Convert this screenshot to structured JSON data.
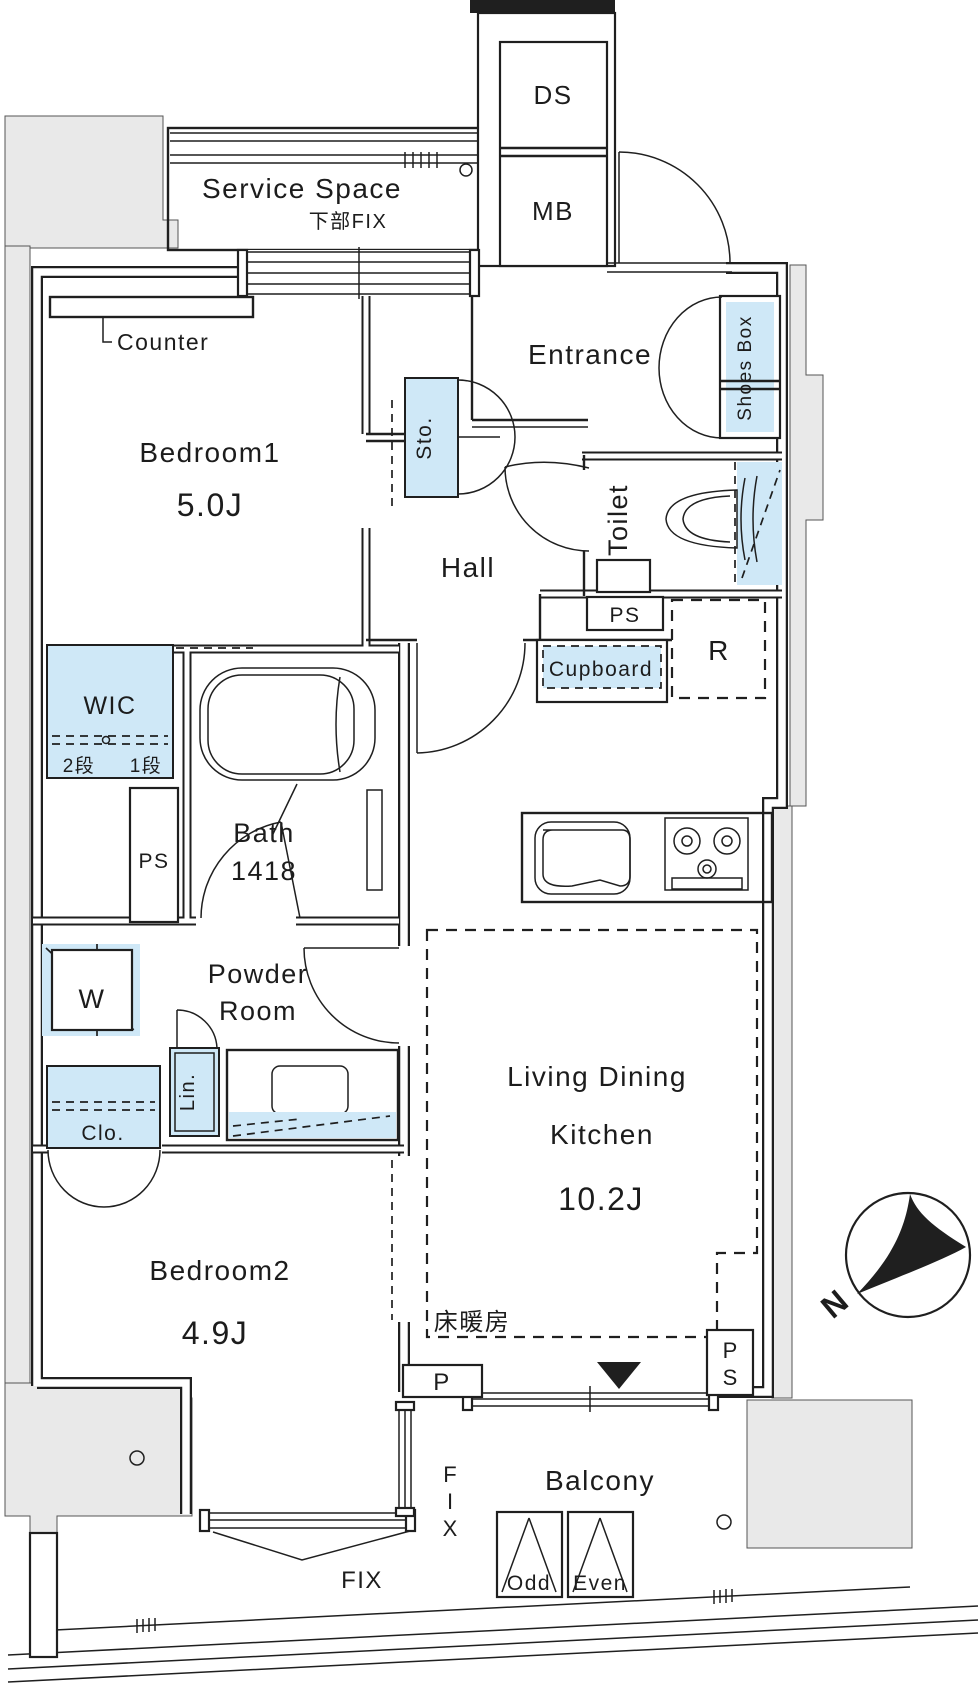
{
  "plan": {
    "type": "apartment-floor-plan",
    "colors": {
      "fixture_blue": "#cfe8f7",
      "outside_grey": "#e9e9e9",
      "wall": "#1f1f1f",
      "background": "#ffffff"
    },
    "labels": {
      "service_space": "Service Space",
      "service_space_sub": "下部FIX",
      "ds": "DS",
      "mb": "MB",
      "entrance": "Entrance",
      "shoes_box": "Shoes Box",
      "toilet": "Toilet",
      "hall": "Hall",
      "storage": "Sto.",
      "counter": "Counter",
      "bedroom1": "Bedroom1",
      "bedroom1_size": "5.0J",
      "wic": "WIC",
      "wic_tier2": "2段",
      "wic_tier1": "1段",
      "ps_left": "PS",
      "ps_center": "PS",
      "ps_bottom": "PS",
      "bath": "Bath",
      "bath_size": "1418",
      "cupboard": "Cupboard",
      "refrigerator": "R",
      "powder_line1": "Powder",
      "powder_line2": "Room",
      "washer": "W",
      "linen": "Lin.",
      "closet": "Clo.",
      "bedroom2": "Bedroom2",
      "bedroom2_size": "4.9J",
      "ldk_line1": "Living Dining",
      "ldk_line2": "Kitchen",
      "ldk_size": "10.2J",
      "floor_heating": "床暖房",
      "p": "P",
      "balcony": "Balcony",
      "hatch_odd": "Odd",
      "hatch_even": "Even",
      "fix": "FIX",
      "fix_side": "FIX",
      "north": "N"
    }
  }
}
